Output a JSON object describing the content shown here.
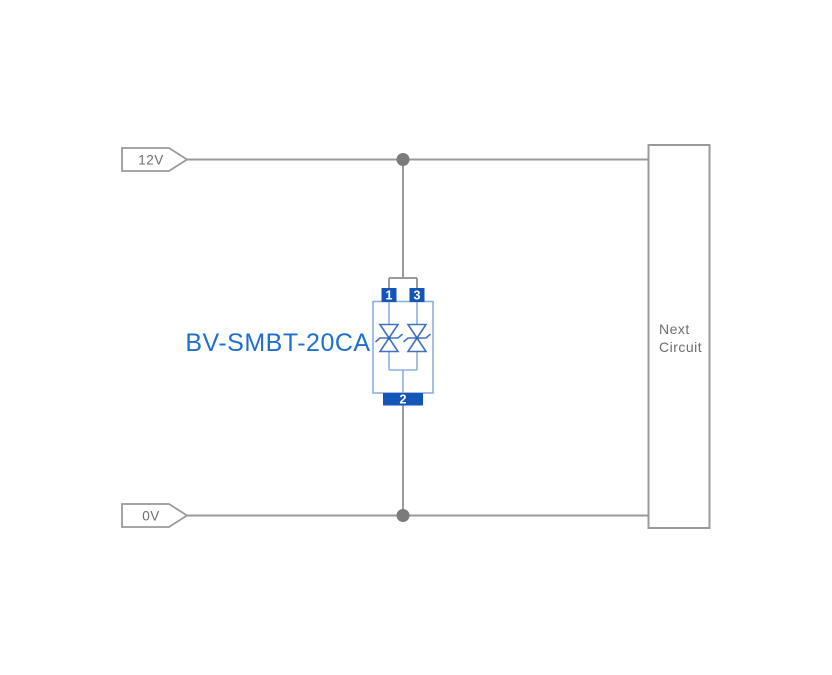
{
  "diagram": {
    "net_labels": {
      "top": "12V",
      "bottom": "0V"
    },
    "component": {
      "label": "BV-SMBT-20CA",
      "pin_top_left": "1",
      "pin_top_right": "3",
      "pin_bottom": "2"
    },
    "next_circuit": {
      "line1": "Next",
      "line2": "Circuit"
    },
    "colors": {
      "wire": "#9a9a9a",
      "junction": "#7b7b7b",
      "text_gray": "#6e6e6e",
      "label_blue": "#1e6fce",
      "pin_fill": "#1356b8",
      "component_outline": "#8cb0de",
      "diode_stroke": "#4272bf",
      "diode_dot": "#2d64bd"
    }
  }
}
